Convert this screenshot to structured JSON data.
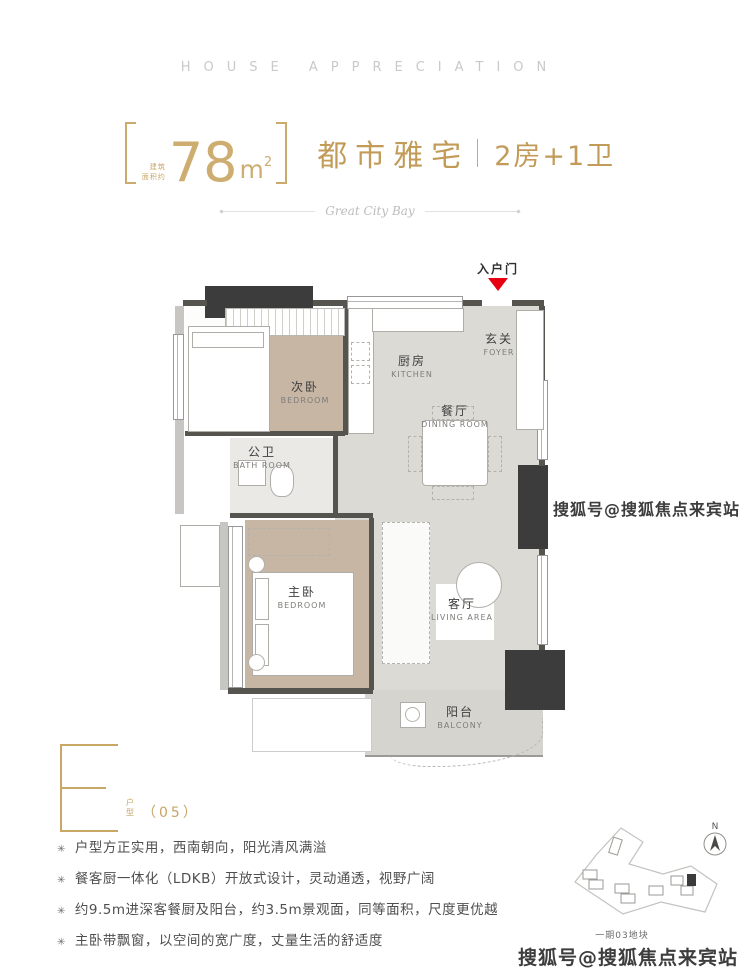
{
  "brand": {
    "kicker": "HOUSE APPRECIATION"
  },
  "headline": {
    "area_note_top": "建筑",
    "area_note_bottom": "面积约",
    "area_value": "78",
    "area_unit_base": "m",
    "area_unit_sup": "2",
    "title": "都市雅宅",
    "spec": "2房+1卫"
  },
  "ribbon": {
    "script": "Great City Bay"
  },
  "plan": {
    "entry": {
      "label": "入户门"
    },
    "rooms": {
      "foyer": {
        "cn": "玄关",
        "en": "FOYER"
      },
      "kitchen": {
        "cn": "厨房",
        "en": "KITCHEN"
      },
      "dining": {
        "cn": "餐厅",
        "en": "DINING ROOM"
      },
      "bedroom2": {
        "cn": "次卧",
        "en": "BEDROOM"
      },
      "bath": {
        "cn": "公卫",
        "en": "BATH ROOM"
      },
      "master": {
        "cn": "主卧",
        "en": "BEDROOM"
      },
      "living": {
        "cn": "客厅",
        "en": "LIVING AREA"
      },
      "balcony": {
        "cn": "阳台",
        "en": "BALCONY"
      }
    }
  },
  "unit": {
    "letter": "E",
    "type_cn_1": "户",
    "type_cn_2": "型",
    "number": "（05）"
  },
  "features": {
    "bullet": "✳",
    "items": [
      "户型方正实用，西南朝向，阳光清风满溢",
      "餐客厨一体化（LDKB）开放式设计，灵动通透，视野广阔",
      "约9.5m进深客餐厨及阳台，约3.5m景观面，同等面积，尺度更优越",
      "主卧带飘窗，以空间的宽广度，丈量生活的舒适度"
    ]
  },
  "sitemap": {
    "compass": "N",
    "caption": "一期03地块"
  },
  "watermarks": {
    "mid": "搜狐号@搜狐焦点来宾站",
    "bottom": "搜狐号@搜狐焦点来宾站"
  },
  "colors": {
    "gold": "#c29b58",
    "wall_dark": "#3c3c3c",
    "floor": "#dbdad5",
    "wood": "#c8b6a4",
    "entry_red": "#e60012"
  }
}
